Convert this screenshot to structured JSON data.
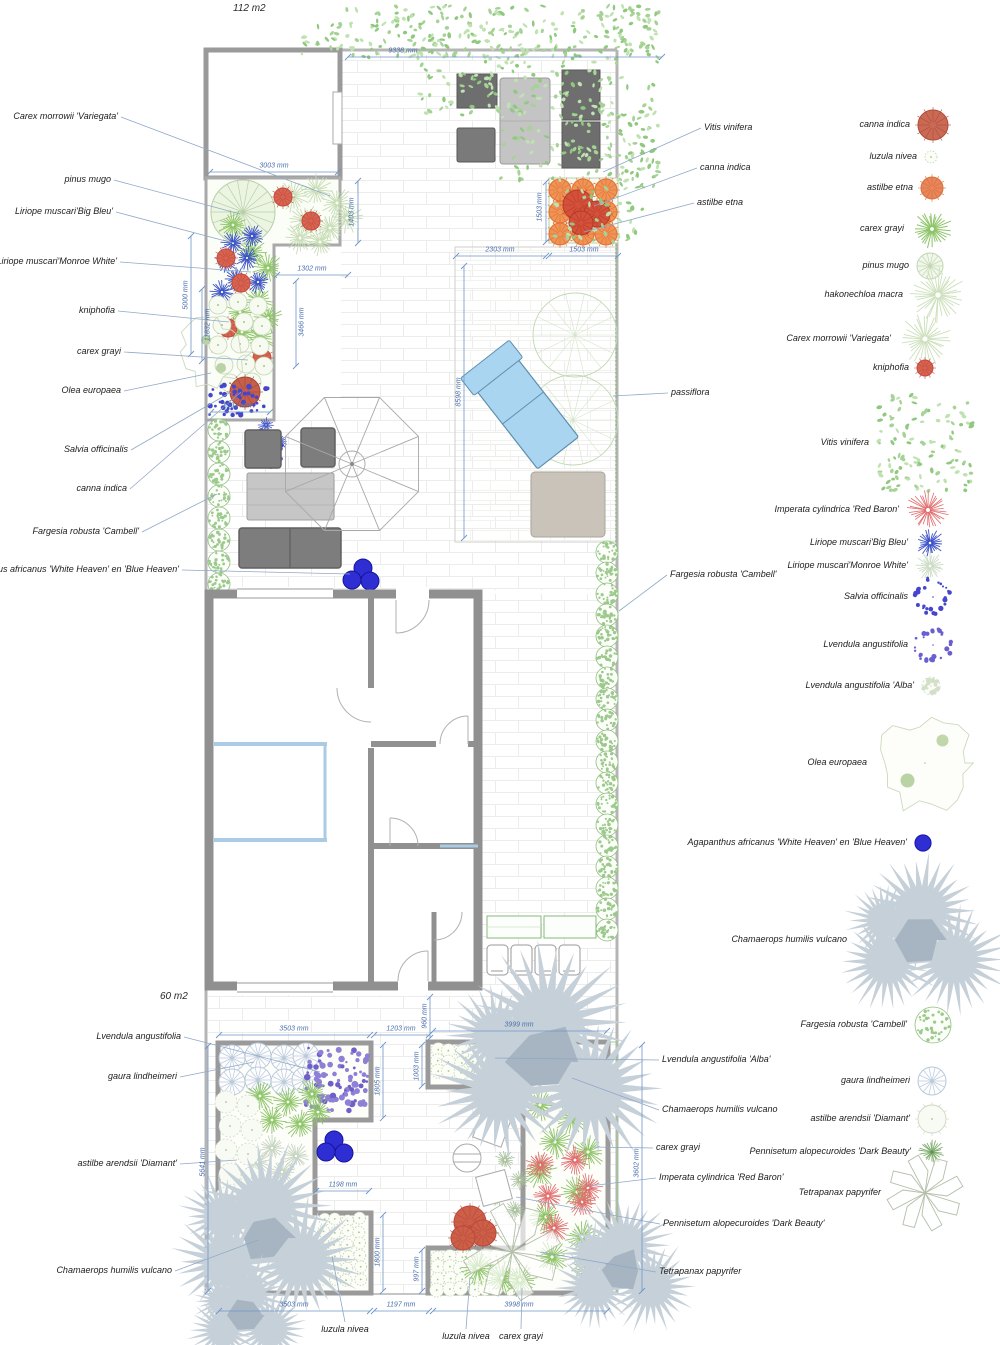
{
  "meta": {
    "area_top": "112 m2",
    "area_bottom": "60 m2"
  },
  "palette": {
    "wall": "#8f8f8f",
    "dim_blue": "#4a6fae",
    "leader": "#8fa8c8",
    "green": "#8cc465",
    "pale_green": "#ccdfba",
    "hedge_green": "#8fbf7f",
    "blue_plant": "#3a50c8",
    "salvia_blue": "#4646cc",
    "lavender": "#8d80d6",
    "red": "#d96452",
    "canna_red": "#c4604c",
    "orange": "#ef9357",
    "agapanthus_blue": "#2e2ed2",
    "palm_gray": "#c6d0d9",
    "palm_dark": "#a7b4c1",
    "imperata_red": "#e06a6a",
    "lounger_blue": "#aad5f1",
    "vitis_green": "#a5d295"
  },
  "labels": {
    "left": [
      {
        "text": "Carex morrowii 'Variegata'",
        "x": 118,
        "y": 117,
        "tx": 330,
        "ty": 196
      },
      {
        "text": "pinus mugo",
        "x": 111,
        "y": 180,
        "tx": 240,
        "ty": 214
      },
      {
        "text": "Liriope muscari'Big Bleu'",
        "x": 113,
        "y": 212,
        "tx": 233,
        "ty": 243
      },
      {
        "text": "Liriope muscari'Monroe White'",
        "x": 117,
        "y": 262,
        "tx": 251,
        "ty": 272
      },
      {
        "text": "kniphofia",
        "x": 115,
        "y": 311,
        "tx": 229,
        "ty": 322
      },
      {
        "text": "carex grayi",
        "x": 121,
        "y": 352,
        "tx": 248,
        "ty": 360
      },
      {
        "text": "Olea europaea",
        "x": 121,
        "y": 391,
        "tx": 211,
        "ty": 373
      },
      {
        "text": "Salvia officinalis",
        "x": 128,
        "y": 450,
        "tx": 231,
        "ty": 392
      },
      {
        "text": "canna indica",
        "x": 127,
        "y": 489,
        "tx": 241,
        "ty": 392
      },
      {
        "text": "Fargesia robusta 'Cambell'",
        "x": 139,
        "y": 532,
        "tx": 217,
        "ty": 494
      },
      {
        "text": "Agapanthus africanus 'White Heaven' en 'Blue Heaven'",
        "x": 179,
        "y": 570,
        "tx": 350,
        "ty": 574
      }
    ],
    "right": [
      {
        "text": "Vitis vinifera",
        "x": 704,
        "y": 128,
        "tx": 603,
        "ty": 172
      },
      {
        "text": "canna indica",
        "x": 700,
        "y": 168,
        "tx": 594,
        "ty": 206
      },
      {
        "text": "astilbe etna",
        "x": 697,
        "y": 203,
        "tx": 584,
        "ty": 232
      },
      {
        "text": "passiflora",
        "x": 671,
        "y": 393,
        "tx": 613,
        "ty": 396
      },
      {
        "text": "Fargesia robusta 'Cambell'",
        "x": 670,
        "y": 575,
        "tx": 619,
        "ty": 611
      }
    ],
    "bottom_left": [
      {
        "text": "Lvendula angustifolia",
        "x": 181,
        "y": 1037,
        "tx": 320,
        "ty": 1072
      },
      {
        "text": "gaura lindheimeri",
        "x": 177,
        "y": 1077,
        "tx": 254,
        "ty": 1062
      },
      {
        "text": "astilbe arendsii 'Diamant'",
        "x": 177,
        "y": 1164,
        "tx": 237,
        "ty": 1160
      },
      {
        "text": "Chamaerops humilis vulcano",
        "x": 172,
        "y": 1271,
        "tx": 258,
        "ty": 1240
      }
    ],
    "bottom_right": [
      {
        "text": "Lvendula angustifolia 'Alba'",
        "x": 662,
        "y": 1060,
        "tx": 495,
        "ty": 1058
      },
      {
        "text": "Chamaerops humilis vulcano",
        "x": 662,
        "y": 1110,
        "tx": 572,
        "ty": 1078
      },
      {
        "text": "carex grayi",
        "x": 656,
        "y": 1148,
        "tx": 593,
        "ty": 1147
      },
      {
        "text": "Imperata cylindrica 'Red Baron'",
        "x": 659,
        "y": 1178,
        "tx": 589,
        "ty": 1186
      },
      {
        "text": "Pennisetum alopecuroides 'Dark Beauty'",
        "x": 663,
        "y": 1224,
        "tx": 516,
        "ty": 1197
      },
      {
        "text": "Tetrapanax papyrifer",
        "x": 659,
        "y": 1272,
        "tx": 540,
        "ty": 1252
      }
    ],
    "bottom": [
      {
        "text": "luzula nivea",
        "x": 345,
        "y": 1330,
        "tx": 332,
        "ty": 1256
      },
      {
        "text": "luzula nivea",
        "x": 466,
        "y": 1337,
        "tx": 470,
        "ty": 1277
      },
      {
        "text": "carex grayi",
        "x": 521,
        "y": 1337,
        "tx": 522,
        "ty": 1288
      }
    ]
  },
  "dimensions": [
    {
      "text": "9338 mm",
      "x": 403,
      "y": 51,
      "rot": 0,
      "l": [
        348,
        57,
        662,
        57
      ]
    },
    {
      "text": "3003 mm",
      "x": 274,
      "y": 166,
      "rot": 0,
      "l": [
        210,
        172,
        338,
        172
      ]
    },
    {
      "text": "1403 mm",
      "x": 352,
      "y": 212,
      "rot": -90,
      "l": [
        358,
        181,
        358,
        243
      ]
    },
    {
      "text": "1302 mm",
      "x": 312,
      "y": 269,
      "rot": 0,
      "l": [
        277,
        275,
        348,
        275
      ]
    },
    {
      "text": "3466 mm",
      "x": 302,
      "y": 322,
      "rot": -90,
      "l": [
        296,
        281,
        296,
        366
      ]
    },
    {
      "text": "5000 mm",
      "x": 186,
      "y": 295,
      "rot": -90,
      "l": [
        191,
        236,
        191,
        354
      ]
    },
    {
      "text": "11832 mm",
      "x": 208,
      "y": 325,
      "rot": -90,
      "l": [
        202,
        289,
        202,
        361
      ]
    },
    {
      "text": "1501 mm",
      "x": 237,
      "y": 406,
      "rot": 0,
      "l": [
        211,
        412,
        270,
        412
      ]
    },
    {
      "text": "2303 mm",
      "x": 500,
      "y": 250,
      "rot": 0,
      "l": [
        456,
        256,
        546,
        256
      ]
    },
    {
      "text": "1503 mm",
      "x": 584,
      "y": 250,
      "rot": 0,
      "l": [
        549,
        256,
        618,
        256
      ]
    },
    {
      "text": "1503 mm",
      "x": 540,
      "y": 207,
      "rot": -90,
      "l": [
        546,
        182,
        546,
        242
      ]
    },
    {
      "text": "8598 mm",
      "x": 459,
      "y": 392,
      "rot": -90,
      "l": [
        464,
        266,
        464,
        538
      ]
    },
    {
      "text": "3999 mm",
      "x": 519,
      "y": 1025,
      "rot": 0,
      "l": [
        433,
        1031,
        607,
        1031
      ]
    },
    {
      "text": "960 mm",
      "x": 425,
      "y": 1016,
      "rot": -90,
      "l": [
        430,
        997,
        430,
        1038
      ]
    },
    {
      "text": "3503 mm",
      "x": 294,
      "y": 1029,
      "rot": 0,
      "l": [
        219,
        1035,
        370,
        1035
      ]
    },
    {
      "text": "1203 mm",
      "x": 401,
      "y": 1029,
      "rot": 0,
      "l": [
        374,
        1035,
        429,
        1035
      ]
    },
    {
      "text": "1003 mm",
      "x": 417,
      "y": 1066,
      "rot": -90,
      "l": [
        422,
        1045,
        422,
        1086
      ]
    },
    {
      "text": "1805 mm",
      "x": 378,
      "y": 1081,
      "rot": -90,
      "l": [
        383,
        1045,
        383,
        1118
      ]
    },
    {
      "text": "5641 mm",
      "x": 203,
      "y": 1162,
      "rot": -90,
      "l": [
        208,
        1046,
        208,
        1291
      ]
    },
    {
      "text": "1198 mm",
      "x": 343,
      "y": 1185,
      "rot": 0,
      "l": [
        316,
        1191,
        369,
        1191
      ]
    },
    {
      "text": "1800 mm",
      "x": 378,
      "y": 1252,
      "rot": -90,
      "l": [
        383,
        1215,
        383,
        1291
      ]
    },
    {
      "text": "997 mm",
      "x": 417,
      "y": 1269,
      "rot": -90,
      "l": [
        422,
        1250,
        422,
        1291
      ]
    },
    {
      "text": "3602 mm",
      "x": 637,
      "y": 1163,
      "rot": -90,
      "l": [
        642,
        1045,
        642,
        1291
      ]
    },
    {
      "text": "3503 mm",
      "x": 294,
      "y": 1305,
      "rot": 0,
      "l": [
        219,
        1311,
        370,
        1311
      ]
    },
    {
      "text": "1197 mm",
      "x": 401,
      "y": 1305,
      "rot": 0,
      "l": [
        374,
        1311,
        429,
        1311
      ]
    },
    {
      "text": "3998 mm",
      "x": 519,
      "y": 1305,
      "rot": 0,
      "l": [
        433,
        1311,
        607,
        1311
      ]
    }
  ],
  "legend": {
    "items": [
      {
        "text": "canna indica",
        "y": 125,
        "sx": 933,
        "r": 15,
        "sym": "canna"
      },
      {
        "text": "luzula nivea",
        "y": 157,
        "sx": 931,
        "r": 6,
        "sym": "luzula"
      },
      {
        "text": "astilbe etna",
        "y": 188,
        "sx": 932,
        "r": 11,
        "sym": "astilbe_etna"
      },
      {
        "text": "carex grayi",
        "y": 229,
        "sx": 932,
        "r": 20,
        "sym": "carex_grayi"
      },
      {
        "text": "pinus mugo",
        "y": 266,
        "sx": 930,
        "r": 13,
        "sym": "pinus"
      },
      {
        "text": "hakonechloa macra",
        "y": 295,
        "sx": 938,
        "r": 27,
        "sym": "hako"
      },
      {
        "text": "Carex morrowii 'Variegata'",
        "y": 339,
        "sx": 925,
        "r": 26,
        "sym": "carex_morrowii"
      },
      {
        "text": "kniphofia",
        "y": 368,
        "sx": 925,
        "r": 8,
        "sym": "kniphofia"
      },
      {
        "text": "Vitis vinifera",
        "y": 443,
        "sx": 925,
        "r": 48,
        "sym": "vitis"
      },
      {
        "text": "Imperata cylindrica 'Red Baron'",
        "y": 510,
        "sx": 928,
        "r": 21,
        "sym": "imperata"
      },
      {
        "text": "Liriope muscari'Big Bleu'",
        "y": 543,
        "sx": 930,
        "r": 14,
        "sym": "liriope_blue"
      },
      {
        "text": "Liriope muscari'Monroe White'",
        "y": 566,
        "sx": 930,
        "r": 14,
        "sym": "liriope_white"
      },
      {
        "text": "Salvia officinalis",
        "y": 597,
        "sx": 933,
        "r": 17,
        "sym": "salvia"
      },
      {
        "text": "Lvendula angustifolia",
        "y": 645,
        "sx": 933,
        "r": 17,
        "sym": "lavender"
      },
      {
        "text": "Lvendula angustifolia 'Alba'",
        "y": 686,
        "sx": 931,
        "r": 9,
        "sym": "lavender_alba"
      },
      {
        "text": "Olea europaea",
        "y": 763,
        "sx": 925,
        "r": 50,
        "sym": "olea"
      },
      {
        "text": "Agapanthus africanus 'White Heaven' en 'Blue Heaven'",
        "y": 843,
        "sx": 923,
        "r": 8,
        "sym": "agapanthus"
      },
      {
        "text": "Chamaerops humilis vulcano",
        "y": 940,
        "sx": 920,
        "r": 65,
        "sym": "palm"
      },
      {
        "text": "Fargesia robusta 'Cambell'",
        "y": 1025,
        "sx": 933,
        "r": 18,
        "sym": "fargesia"
      },
      {
        "text": "gaura lindheimeri",
        "y": 1081,
        "sx": 932,
        "r": 14,
        "sym": "gaura"
      },
      {
        "text": "astilbe arendsii 'Diamant'",
        "y": 1119,
        "sx": 932,
        "r": 14,
        "sym": "astilbe_diamant"
      },
      {
        "text": "Pennisetum alopecuroides 'Dark Beauty'",
        "y": 1152,
        "sx": 932,
        "r": 13,
        "sym": "pennisetum"
      },
      {
        "text": "Tetrapanax papyrifer",
        "y": 1193,
        "sx": 925,
        "r": 36,
        "sym": "tetrapanax"
      }
    ]
  }
}
